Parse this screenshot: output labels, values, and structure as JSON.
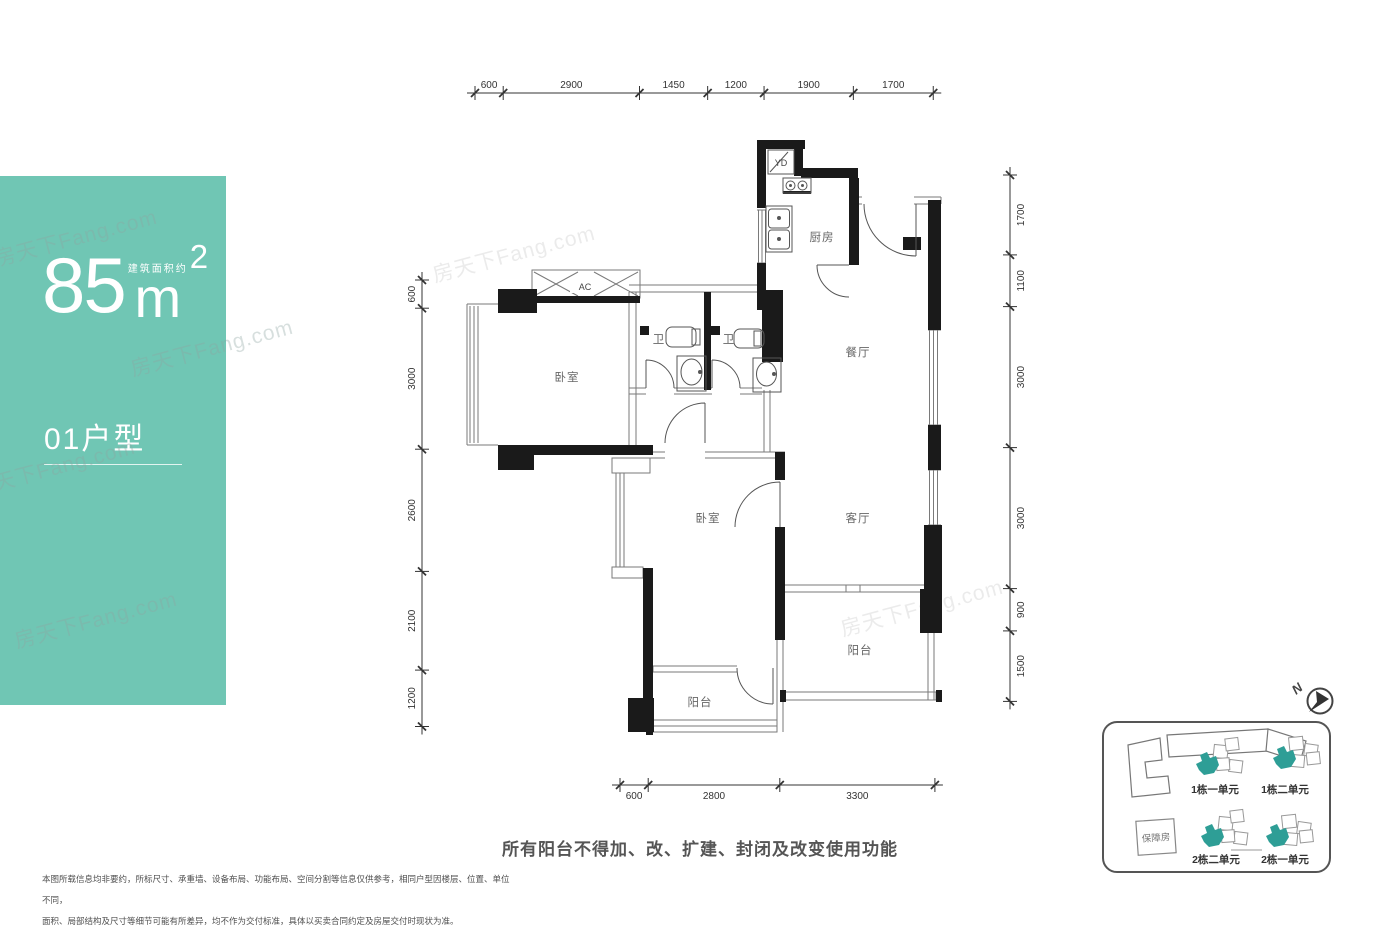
{
  "panel": {
    "area_value": "85",
    "area_unit": "m",
    "area_sup": "2",
    "area_note": "建筑面积约",
    "unit_label": "01户型"
  },
  "floorplan": {
    "rooms": {
      "bedroom": "卧室",
      "bath": "卫",
      "kitchen": "厨房",
      "dining": "餐厅",
      "living": "客厅",
      "balcony": "阳台",
      "flue": "YD",
      "ac": "AC"
    },
    "dimensions": {
      "top": {
        "values": [
          600,
          2900,
          1450,
          1200,
          1900,
          1700
        ]
      },
      "bottom": {
        "values": [
          600,
          2800,
          3300
        ]
      },
      "left": {
        "values": [
          600,
          3000,
          2600,
          2100,
          1200
        ]
      },
      "right": {
        "values": [
          1700,
          1100,
          3000,
          3000,
          900,
          1500
        ]
      }
    }
  },
  "notice": "所有阳台不得加、改、扩建、封闭及改变使用功能",
  "disclaimer": {
    "line1": "本图所载信息均非要约，所标尺寸、承重墙、设备布局、功能布局、空间分割等信息仅供参考，相同户型因楼层、位置、单位不同，",
    "line2": "面积、局部结构及尺寸等细节可能有所差异，均不作为交付标准，具体以买卖合同约定及房屋交付时现状为准。"
  },
  "siteplan": {
    "units": [
      {
        "label": "1栋一单元"
      },
      {
        "label": "1栋二单元"
      },
      {
        "label": "2栋二单元"
      },
      {
        "label": "2栋一单元"
      }
    ],
    "social_housing": "保障房",
    "north": "N"
  },
  "watermark": "房天下Fang.com",
  "colors": {
    "accent_teal": "#70C6B4",
    "unit_teal": "#2E9E96",
    "wall": "#1a1a1a"
  }
}
